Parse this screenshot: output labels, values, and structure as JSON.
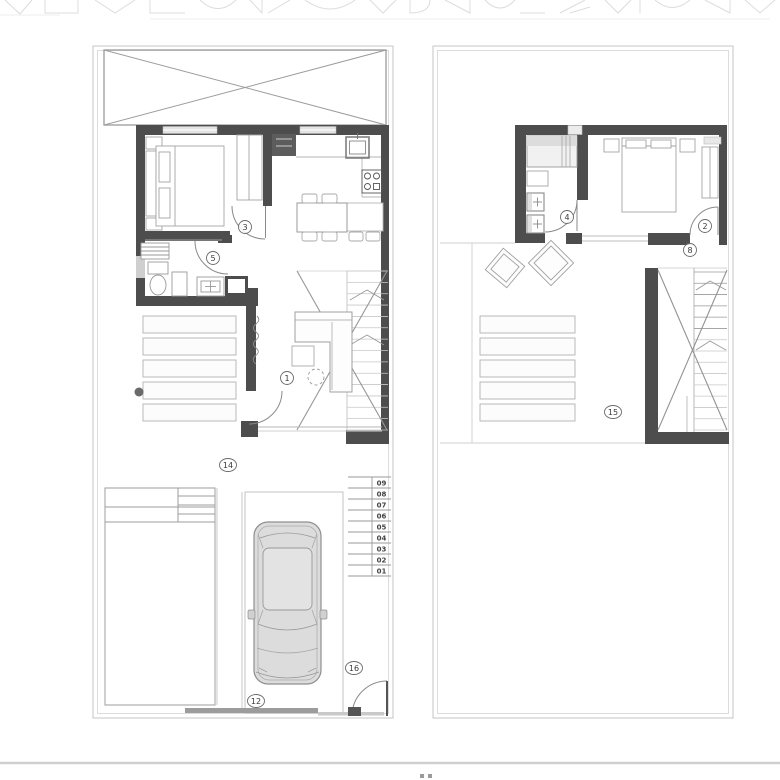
{
  "document": {
    "type": "architectural-floor-plan-sheet",
    "sheet_note": "two stacked dwelling floor plans, drawing cropped at top and bottom"
  },
  "colors": {
    "wall": "#4d4d4d",
    "medium_line": "#8e8e8e",
    "furniture_line": "#a3a3a3",
    "light_line": "#c4c4c4",
    "car_fill": "#dcdcdc",
    "label_ink": "#3a3a3a",
    "page_rule": "#cfcfcf"
  },
  "plans": {
    "ground_floor": {
      "name": "ground-floor-plan",
      "room_labels": [
        {
          "text": "3",
          "x": 245,
          "y": 227
        },
        {
          "text": "5",
          "x": 213,
          "y": 258
        },
        {
          "text": "1",
          "x": 287,
          "y": 378
        },
        {
          "text": "14",
          "x": 228,
          "y": 465
        },
        {
          "text": "16",
          "x": 354,
          "y": 668
        },
        {
          "text": "12",
          "x": 256,
          "y": 701
        }
      ],
      "stair_step_numbers": [
        "09",
        "08",
        "07",
        "06",
        "05",
        "04",
        "03",
        "02",
        "01"
      ]
    },
    "upper_floor": {
      "name": "upper-floor-plan",
      "room_labels": [
        {
          "text": "4",
          "x": 567,
          "y": 217
        },
        {
          "text": "2",
          "x": 705,
          "y": 226
        },
        {
          "text": "8",
          "x": 690,
          "y": 250
        },
        {
          "text": "15",
          "x": 613,
          "y": 412
        }
      ]
    }
  }
}
